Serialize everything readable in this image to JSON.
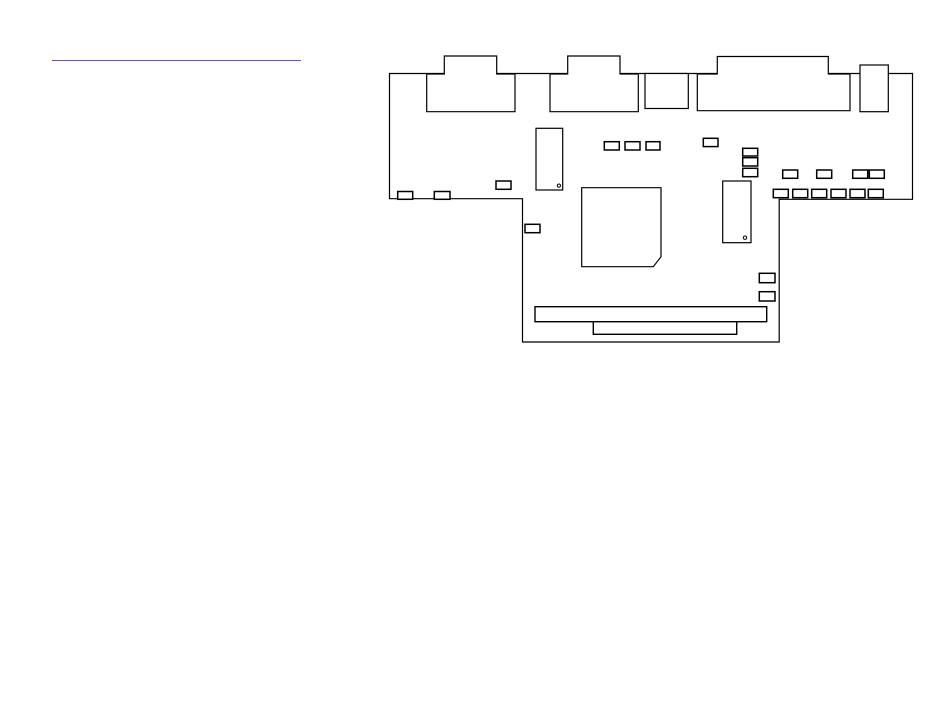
{
  "page": {
    "width": 950,
    "height": 725,
    "background_color": "#ffffff"
  },
  "heading_rule": {
    "x1": 52,
    "y1": 60.5,
    "x2": 301,
    "y2": 60.5,
    "thickness": 1.8,
    "color": "#5a55dc"
  },
  "diagram": {
    "description": "logic-board-outline-drawing",
    "stroke_color": "#000000",
    "fill_color": "#ffffff",
    "default_stroke_width": 1.2,
    "shapes": [
      {
        "name": "board-outline",
        "type": "polygon",
        "stroke_width": 1.2,
        "points": [
          [
            389.5,
            73.5
          ],
          [
            912.5,
            73.5
          ],
          [
            912.5,
            199.3
          ],
          [
            779.2,
            199.3
          ],
          [
            779.2,
            342
          ],
          [
            522.5,
            342
          ],
          [
            522.5,
            198.7
          ],
          [
            389.5,
            198.7
          ]
        ]
      },
      {
        "name": "port-connector-1",
        "type": "polygon",
        "stroke_width": 1.2,
        "points": [
          [
            426.7,
            111.7
          ],
          [
            426.7,
            74
          ],
          [
            444.3,
            74
          ],
          [
            444.3,
            56
          ],
          [
            496.7,
            56
          ],
          [
            496.7,
            74
          ],
          [
            515,
            74
          ],
          [
            515,
            111.7
          ]
        ]
      },
      {
        "name": "port-connector-2",
        "type": "polygon",
        "stroke_width": 1.2,
        "points": [
          [
            550,
            111.7
          ],
          [
            550,
            74
          ],
          [
            567.7,
            74
          ],
          [
            567.7,
            56
          ],
          [
            620,
            56
          ],
          [
            620,
            74
          ],
          [
            638.3,
            74
          ],
          [
            638.3,
            111.7
          ]
        ]
      },
      {
        "name": "port-connector-3",
        "type": "rect",
        "x": 645,
        "y": 73.5,
        "w": 43.3,
        "h": 35,
        "stroke_width": 1.2
      },
      {
        "name": "port-connector-4",
        "type": "polygon",
        "stroke_width": 1.2,
        "points": [
          [
            697.3,
            110.7
          ],
          [
            697.3,
            74
          ],
          [
            717.3,
            74
          ],
          [
            717.3,
            56.5
          ],
          [
            828.3,
            56.5
          ],
          [
            828.3,
            74
          ],
          [
            850,
            74
          ],
          [
            850,
            110.7
          ]
        ]
      },
      {
        "name": "port-connector-5",
        "type": "rect",
        "x": 860,
        "y": 65,
        "w": 28.3,
        "h": 46.7,
        "stroke_width": 1.2
      },
      {
        "name": "ic-dip-1",
        "type": "rect",
        "x": 536,
        "y": 128.3,
        "w": 26.7,
        "h": 61.7,
        "stroke_width": 1.2
      },
      {
        "name": "ic-dip-1-pin1-dot",
        "type": "circle",
        "cx": 558.9,
        "cy": 185.6,
        "r": 1.6,
        "stroke_width": 1
      },
      {
        "name": "main-chip",
        "type": "polygon",
        "stroke_width": 1.2,
        "points": [
          [
            581.7,
            187.7
          ],
          [
            661,
            187.7
          ],
          [
            661,
            256.7
          ],
          [
            653.3,
            266.7
          ],
          [
            581.7,
            266.7
          ]
        ]
      },
      {
        "name": "ic-dip-2",
        "type": "rect",
        "x": 722.7,
        "y": 181,
        "w": 28.3,
        "h": 61.7,
        "stroke_width": 1.2
      },
      {
        "name": "ic-dip-2-pin1-dot",
        "type": "circle",
        "cx": 745,
        "cy": 237.7,
        "r": 1.7,
        "stroke_width": 1
      },
      {
        "name": "component-left-1",
        "type": "rect",
        "x": 397.7,
        "y": 191.5,
        "w": 15,
        "h": 7.8,
        "stroke_width": 1.5
      },
      {
        "name": "component-left-2",
        "type": "rect",
        "x": 434.3,
        "y": 191.5,
        "w": 15.7,
        "h": 7.8,
        "stroke_width": 1.5
      },
      {
        "name": "component-left-3",
        "type": "rect",
        "x": 496,
        "y": 181,
        "w": 15,
        "h": 8.3,
        "stroke_width": 1.5
      },
      {
        "name": "component-mid-1",
        "type": "rect",
        "x": 604.3,
        "y": 141.7,
        "w": 15,
        "h": 8.3,
        "stroke_width": 1.5
      },
      {
        "name": "component-mid-2",
        "type": "rect",
        "x": 625,
        "y": 141.7,
        "w": 15,
        "h": 8.3,
        "stroke_width": 1.5
      },
      {
        "name": "component-mid-3",
        "type": "rect",
        "x": 646,
        "y": 141.7,
        "w": 14,
        "h": 8.3,
        "stroke_width": 1.5
      },
      {
        "name": "component-single-1",
        "type": "rect",
        "x": 703.3,
        "y": 138.3,
        "w": 14.7,
        "h": 8.3,
        "stroke_width": 1.5
      },
      {
        "name": "component-stack-1",
        "type": "rect",
        "x": 742.7,
        "y": 148.3,
        "w": 15,
        "h": 7.7,
        "stroke_width": 1.5
      },
      {
        "name": "component-stack-2",
        "type": "rect",
        "x": 742.7,
        "y": 157.7,
        "w": 15,
        "h": 8.3,
        "stroke_width": 1.5
      },
      {
        "name": "component-stack-3",
        "type": "rect",
        "x": 742.7,
        "y": 168.3,
        "w": 15,
        "h": 8.4,
        "stroke_width": 1.5
      },
      {
        "name": "component-row4-1",
        "type": "rect",
        "x": 782.7,
        "y": 170,
        "w": 15,
        "h": 8.3,
        "stroke_width": 1.5
      },
      {
        "name": "component-row4-2",
        "type": "rect",
        "x": 816.7,
        "y": 170,
        "w": 15,
        "h": 8.3,
        "stroke_width": 1.5
      },
      {
        "name": "component-row4-3",
        "type": "rect",
        "x": 852.7,
        "y": 170,
        "w": 15,
        "h": 8.3,
        "stroke_width": 1.5
      },
      {
        "name": "component-row4-4",
        "type": "rect",
        "x": 869.3,
        "y": 170,
        "w": 15,
        "h": 8.3,
        "stroke_width": 1.5
      },
      {
        "name": "component-row6-1",
        "type": "rect",
        "x": 773.3,
        "y": 189.3,
        "w": 15,
        "h": 8.4,
        "stroke_width": 1.5
      },
      {
        "name": "component-row6-2",
        "type": "rect",
        "x": 792.7,
        "y": 189.3,
        "w": 15,
        "h": 8.4,
        "stroke_width": 1.5
      },
      {
        "name": "component-row6-3",
        "type": "rect",
        "x": 811.7,
        "y": 189.3,
        "w": 15,
        "h": 8.4,
        "stroke_width": 1.5
      },
      {
        "name": "component-row6-4",
        "type": "rect",
        "x": 831,
        "y": 189.3,
        "w": 15,
        "h": 8.4,
        "stroke_width": 1.5
      },
      {
        "name": "component-row6-5",
        "type": "rect",
        "x": 850,
        "y": 189.3,
        "w": 15,
        "h": 8.4,
        "stroke_width": 1.5
      },
      {
        "name": "component-row6-6",
        "type": "rect",
        "x": 868.3,
        "y": 189.3,
        "w": 15,
        "h": 8.4,
        "stroke_width": 1.5
      },
      {
        "name": "component-edge-1",
        "type": "rect",
        "x": 525,
        "y": 224.3,
        "w": 15,
        "h": 8.4,
        "stroke_width": 1.5
      },
      {
        "name": "component-right-1",
        "type": "rect",
        "x": 759.3,
        "y": 273.3,
        "w": 15.7,
        "h": 9.4,
        "stroke_width": 1.5
      },
      {
        "name": "component-right-2",
        "type": "rect",
        "x": 759.3,
        "y": 291.7,
        "w": 15.7,
        "h": 9.3,
        "stroke_width": 1.5
      },
      {
        "name": "memory-socket",
        "type": "rect",
        "x": 535,
        "y": 306.7,
        "w": 231.7,
        "h": 15,
        "stroke_width": 1.4
      },
      {
        "name": "memory-socket-inner",
        "type": "rect",
        "x": 593.3,
        "y": 321.7,
        "w": 143.4,
        "h": 12.6,
        "stroke_width": 1.4
      }
    ]
  }
}
